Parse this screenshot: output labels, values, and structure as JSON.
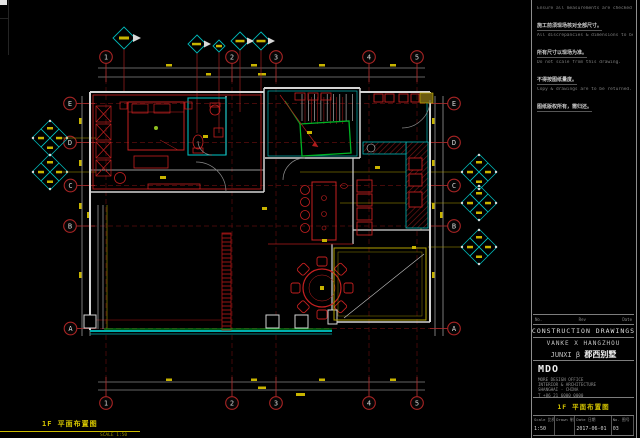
{
  "grid": {
    "cols": [
      "1",
      "2",
      "3",
      "4",
      "5"
    ],
    "rows": [
      "E",
      "D",
      "C",
      "B",
      "A"
    ]
  },
  "notes": {
    "lines": [
      {
        "text": "Ensure all measurements are checked & verified on site",
        "style": "en"
      },
      {
        "text": "施工前须现场核对全部尺寸。",
        "style": "zh"
      },
      {
        "text": "All discrepancies & dimensions to be verified on site",
        "style": "en"
      },
      {
        "text": "所有尺寸以现场为准。",
        "style": "zh"
      },
      {
        "text": "Do not scale from this drawing.",
        "style": "en"
      },
      {
        "text": "不得按图纸量度。",
        "style": "zh"
      },
      {
        "text": "Copy & drawings are to be returned.",
        "style": "en"
      },
      {
        "text": "图纸版权所有，需归还。",
        "style": "zh"
      }
    ]
  },
  "titleblock": {
    "rev_headers": [
      "No.",
      "Rev",
      "Date"
    ],
    "doc_type": "CONSTRUCTION DRAWINGS",
    "project_en": "VANKE X HANGZHOU",
    "project_code": "JUNXI β",
    "project_zh": "郡西别墅",
    "firm_name": "MDO",
    "firm_lines": [
      "MORE DESIGN OFFICE",
      "INTERIOR & ARCHITECTURE",
      "SHANGHAI · CHINA",
      "T +86 21 6000 0000"
    ],
    "drawing_title": "1F 平面布置图",
    "fields": [
      {
        "label": "Scale 比例",
        "value": "1:50"
      },
      {
        "label": "Drawn 制图",
        "value": ""
      },
      {
        "label": "Date 日期",
        "value": "2017-06-01"
      },
      {
        "label": "No. 图号",
        "value": "03"
      }
    ]
  },
  "footer_label": {
    "title": "1F 平面布置图",
    "scale": "SCALE 1:50"
  },
  "colors": {
    "wall_white": "#d4d4d4",
    "cad_red": "#c52020",
    "grid_red": "#a82424",
    "cyan": "#00b8b8",
    "green": "#00b325",
    "yellow": "#c8b400",
    "title_yellow": "#d3c300"
  }
}
